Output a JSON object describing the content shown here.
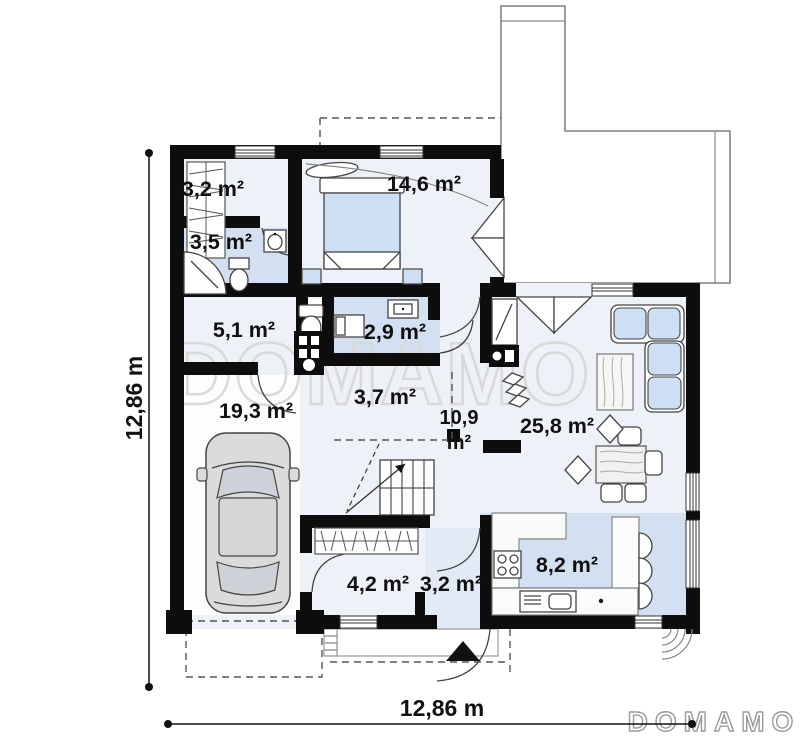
{
  "watermarks": {
    "center": "DOMAMO",
    "logo": "DOMAMO"
  },
  "dimensions": {
    "left": "12,86 m",
    "bottom": "12,86 m"
  },
  "rooms": [
    {
      "name": "wardrobe-top",
      "area": "3,2 m²"
    },
    {
      "name": "bedroom",
      "area": "14,6 m²"
    },
    {
      "name": "bathroom",
      "area": "3,5 m²"
    },
    {
      "name": "utility-room",
      "area": "5,1 m²"
    },
    {
      "name": "wc",
      "area": "2,9 m²"
    },
    {
      "name": "garage",
      "area": "19,3 m²"
    },
    {
      "name": "inner-hall",
      "area": "3,7 m²"
    },
    {
      "name": "hallway",
      "area_value": "10,9",
      "area_unit": "m²"
    },
    {
      "name": "living-room",
      "area": "25,8 m²"
    },
    {
      "name": "kitchen",
      "area": "8,2 m²"
    },
    {
      "name": "wardrobe-bottom",
      "area": "4,2 m²"
    },
    {
      "name": "entry",
      "area": "3,2 m²"
    }
  ],
  "colors": {
    "wall": "#0d0d0d",
    "floor_light": "#eef1f8",
    "floor_blue": "#d3e0f1",
    "floor_entry": "#e2eaf6",
    "furn_blue": "#cddff2",
    "car_body": "#dbdbdb",
    "watermark": "#d9d9d9",
    "logo": "#9b9b9b"
  }
}
